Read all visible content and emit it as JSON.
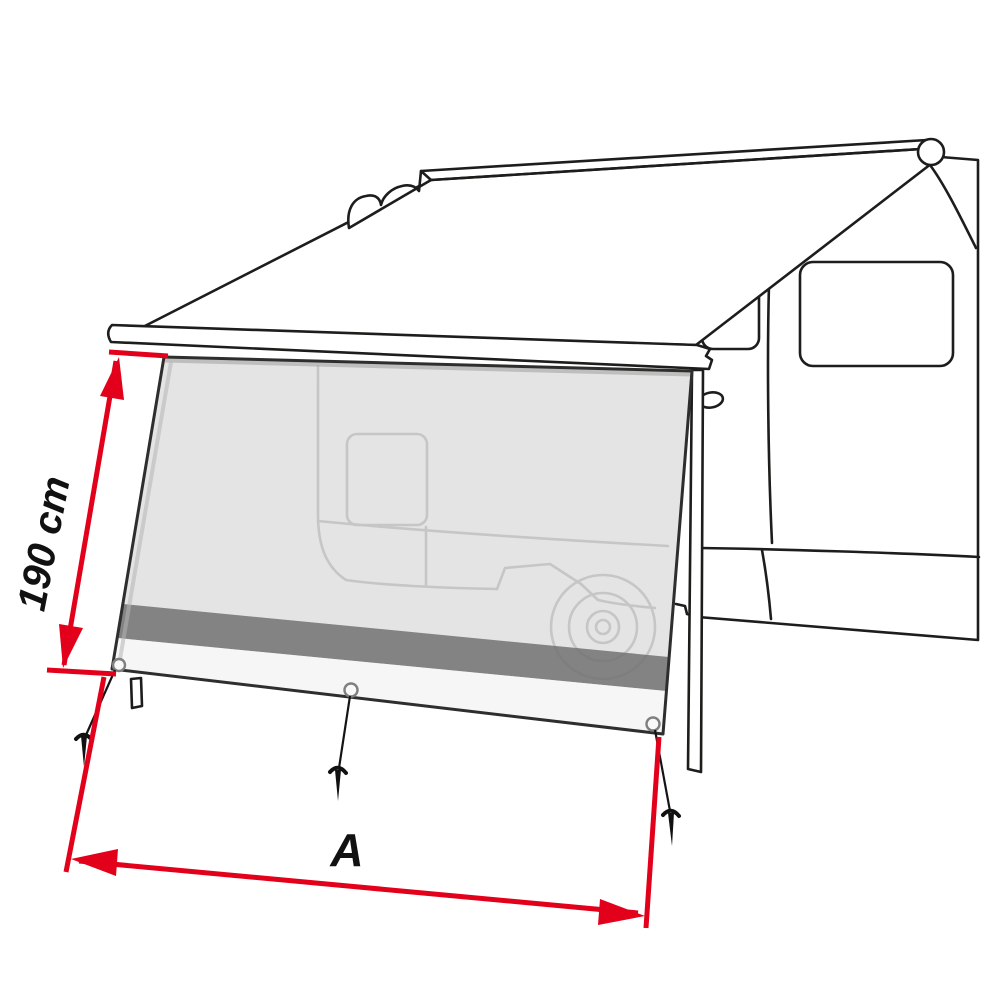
{
  "diagram": {
    "labels": {
      "height_dimension": "190 cm",
      "width_dimension": "A"
    },
    "colors": {
      "background": "#ffffff",
      "line_black": "#1d1d1b",
      "dimension_red": "#e2001a",
      "panel_fill": "#e4e4e4",
      "panel_stripe": "#8c8c8c",
      "panel_bottom": "#f5f5f5",
      "ghost_line": "#c6c6c6"
    },
    "parts": [
      "motorhome-outline",
      "awning-cassette",
      "awning-fabric",
      "front-lead-bar",
      "support-leg",
      "side-shade-panel",
      "panel-dark-stripe",
      "grommets",
      "guy-lines",
      "ground-pegs",
      "height-dimension-arrow",
      "width-dimension-arrow"
    ]
  }
}
